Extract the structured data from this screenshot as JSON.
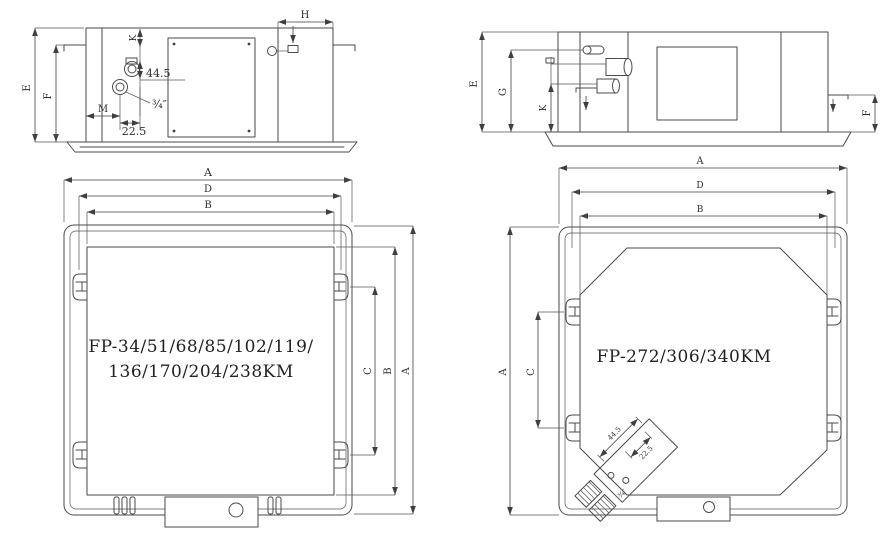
{
  "page": {
    "background": "#ffffff",
    "line_color": "#4a4a4a"
  },
  "drawing": {
    "dim_labels": {
      "A": "A",
      "B": "B",
      "C": "C",
      "D": "D",
      "E": "E",
      "F": "F",
      "G": "G",
      "H": "H",
      "K": "K",
      "M": "M"
    },
    "dim_values": {
      "pipe_spacing": "44.5",
      "pipe_offset": "22.5",
      "pipe_size": "¾″"
    },
    "models": {
      "small_units_line1": "FP-34/51/68/85/102/119/",
      "small_units_line2": "136/170/204/238KM",
      "large_units": "FP-272/306/340KM"
    }
  }
}
